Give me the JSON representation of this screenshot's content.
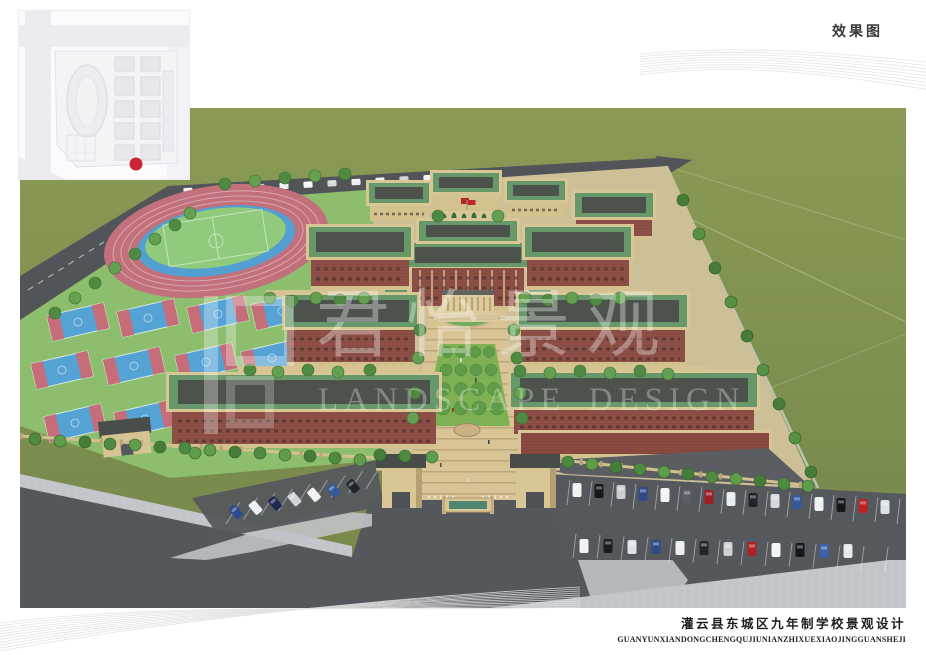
{
  "header": {
    "label": "效果图"
  },
  "watermark": {
    "cn": "君怡景观",
    "en": "LANDSCAPE DESIGN"
  },
  "footer": {
    "title_cn": "灌云县东城区九年制学校景观设计",
    "title_pinyin": "GUANYUNXIANDONGCHENGQUJIUNIANZHIXUEXIAOJINGGUANSHEJI"
  },
  "inset_map": {
    "marker_color": "#cb2433"
  },
  "colors": {
    "grass": "#7f9150",
    "road": "#54575c",
    "sidewalk": "#c2c5ca",
    "track_red": "#c2707b",
    "track_blue": "#549fd2",
    "field_green": "#8fca7d",
    "court_blue": "#55a3d4",
    "brick": "#8e5046",
    "stone_tan": "#d6c493",
    "roof_green": "#67986a",
    "roof_dark": "#4e524d",
    "plaza_paving": "#d8c495",
    "tree_green": "#4f8a42",
    "flag_red": "#c0272d"
  }
}
